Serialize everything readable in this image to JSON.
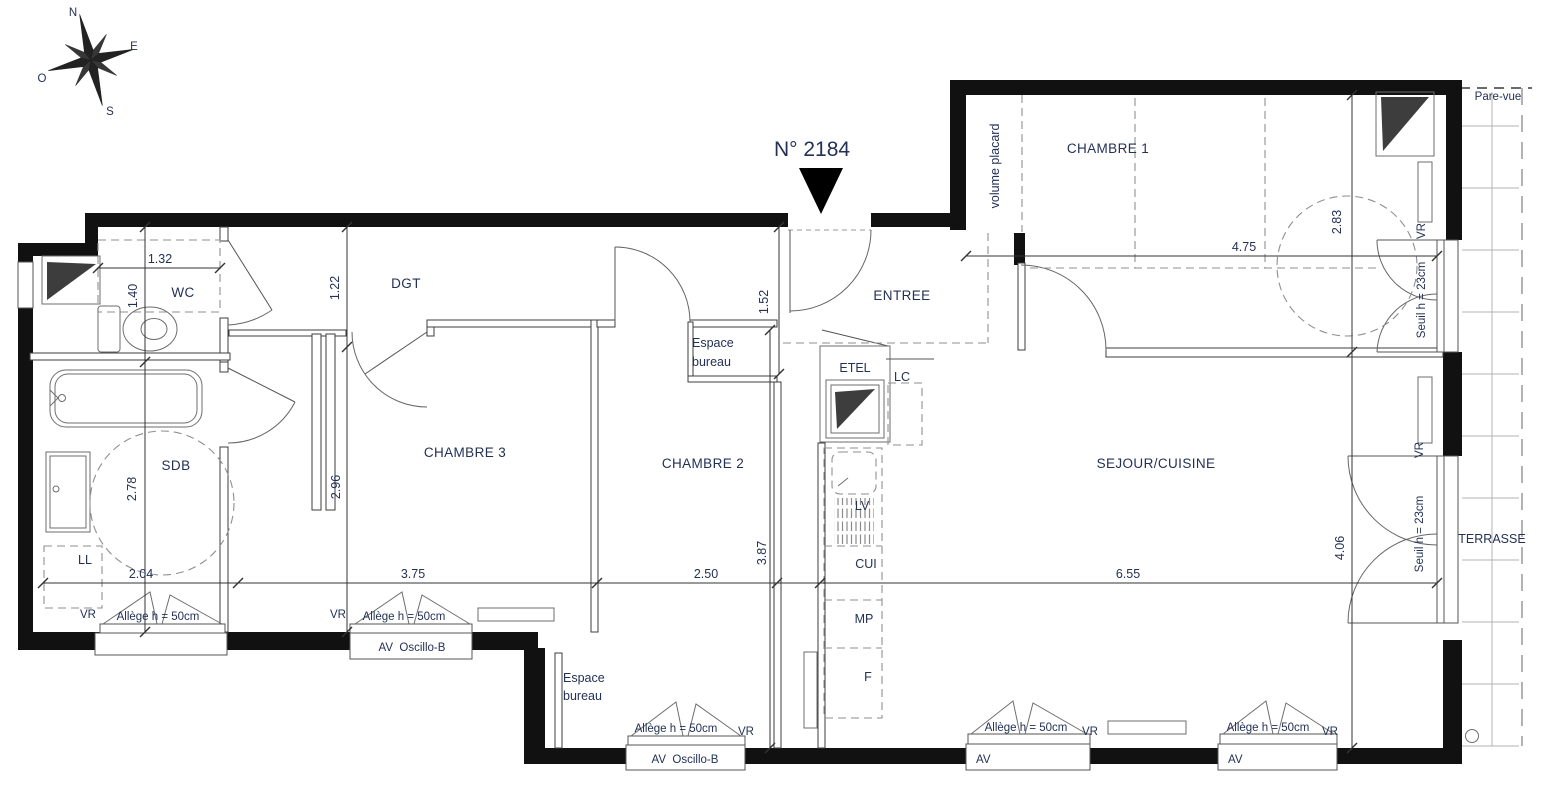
{
  "unit": "N° 2184",
  "compass": {
    "n": "N",
    "e": "E",
    "o": "O",
    "s": "S"
  },
  "rooms": {
    "entree": "ENTREE",
    "dgt": "DGT",
    "wc": "WC",
    "sdb": "SDB",
    "chambre1": "CHAMBRE 1",
    "chambre2": "CHAMBRE 2",
    "chambre3": "CHAMBRE 3",
    "sejour": "SEJOUR/CUISINE",
    "terrasse": "TERRASSE",
    "volume_placard": "volume placard",
    "espace_bureau_l1": "Espace",
    "espace_bureau_l2": "bureau"
  },
  "equipment": {
    "etel": "ETEL",
    "lc": "LC",
    "ll": "LL",
    "lv": "LV",
    "cui": "CUI",
    "mp": "MP",
    "f": "F"
  },
  "dims": {
    "wc_width": "1.32",
    "wc_depth": "1.40",
    "dgt_depth": "1.22",
    "entree_width": "1.52",
    "sdb_width": "2.04",
    "sdb_depth": "2.78",
    "chambre3_width": "3.75",
    "chambre3_depth": "2.96",
    "chambre2_width": "2.50",
    "chambre2_depth": "3.87",
    "sejour_width": "6.55",
    "sejour_depth": "4.06",
    "chambre1_width": "4.75",
    "chambre1_depth": "2.83"
  },
  "ann": {
    "pare_vue": "Pare-vue",
    "vr": "VR",
    "allege": "Allège h = 50cm",
    "av_oscillo": "AV  Oscillo-B",
    "av": "AV",
    "seuil": "Seuil h = 23cm"
  },
  "colors": {
    "text": "#233156",
    "walls": "#111111",
    "background": "#ffffff"
  }
}
